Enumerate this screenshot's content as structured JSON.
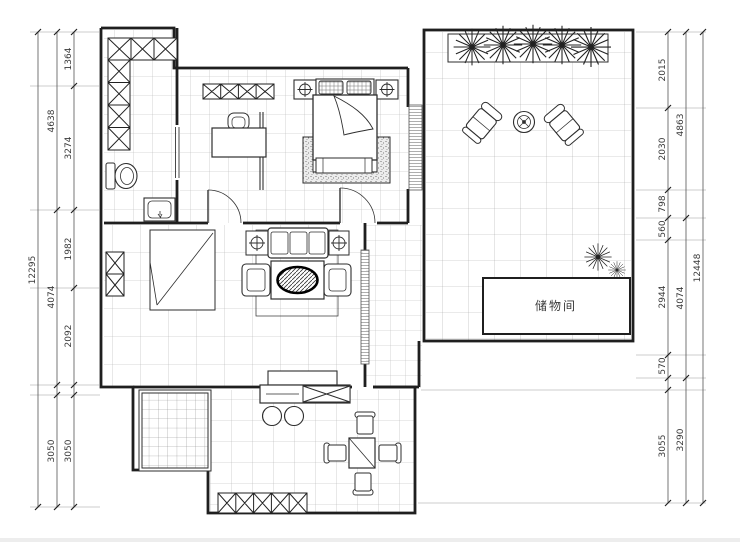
{
  "plan": {
    "room_labels": {
      "storage": "储物间"
    },
    "dimensions": {
      "left": {
        "outer": [
          "12295"
        ],
        "middle": [
          "4638",
          "4074",
          "3050"
        ],
        "inner": [
          "1364",
          "3274",
          "1982",
          "2092",
          "3050"
        ]
      },
      "right": {
        "outer": [
          "12448"
        ],
        "middle": [
          "4863",
          "4074",
          "3290"
        ],
        "inner": [
          "2015",
          "2030",
          "798",
          "560",
          "2944",
          "570",
          "3055"
        ]
      }
    },
    "symbols": [
      "double-bed",
      "pillows",
      "wardrobe-x-cabinet",
      "toilet",
      "wash-basin",
      "desk",
      "desk-chair",
      "sofa-set",
      "table-lamp",
      "coffee-table-oval-rug",
      "tv-cabinet",
      "bar-stools",
      "dining-table",
      "dining-chairs",
      "lounge-chairs",
      "round-tea-table",
      "planter-plants",
      "snow-plants",
      "storage-room",
      "kitchen-floor-mat",
      "door-swing",
      "window-strip",
      "floor-tiles"
    ],
    "colors": {
      "wall": "#1f1f1f",
      "furniture_line": "#2e2e2e",
      "tile_grid": "#b5b5b5",
      "background": "#ffffff",
      "dimension_text": "#3a3a3a"
    }
  }
}
